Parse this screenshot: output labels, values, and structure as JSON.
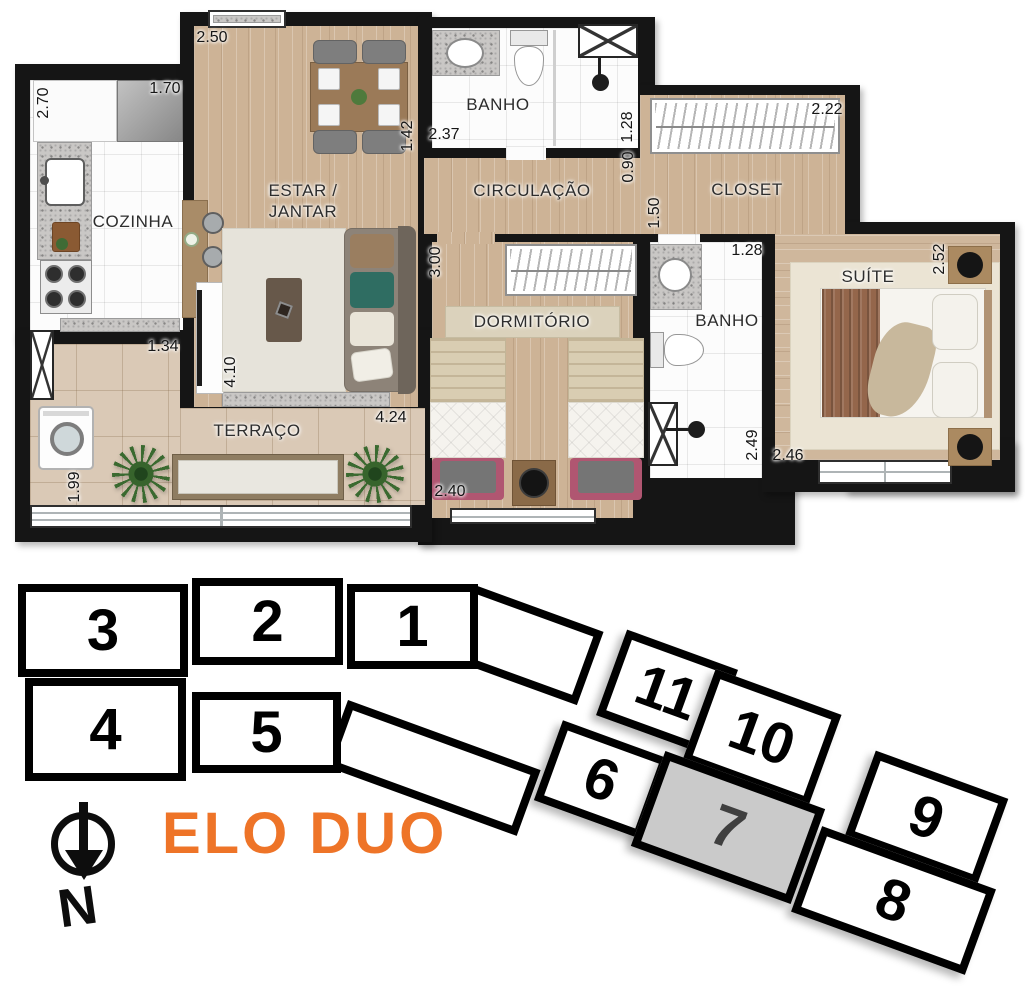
{
  "floor_plan": {
    "rooms": {
      "cozinha": "COZINHA",
      "estar_jantar_line1": "ESTAR /",
      "estar_jantar_line2": "JANTAR",
      "banho_superior": "BANHO",
      "circulacao": "CIRCULAÇÃO",
      "closet": "CLOSET",
      "dormitorio": "DORMITÓRIO",
      "banho_suite": "BANHO",
      "suite": "SUÍTE",
      "terraco": "TERRAÇO"
    },
    "dimensions": {
      "cozinha_profundidade": "2.70",
      "cozinha_largura": "1.70",
      "estar_largura_topo": "2.50",
      "estar_lateral": "1.42",
      "banho_sup_largura": "2.37",
      "banho_sup_profundidade": "1.28",
      "circulacao_largura": "0.90",
      "closet_largura": "2.22",
      "closet_passagem": "1.50",
      "banho_suite_largura": "1.28",
      "suite_profundidade": "2.52",
      "dormitorio_profundidade": "3.00",
      "dormitorio_largura": "2.40",
      "banho_suite_profundidade": "2.49",
      "suite_largura": "2.46",
      "terraco_recuo": "1.34",
      "estar_profundidade": "4.10",
      "terraco_largura": "4.24",
      "terraco_profundidade": "1.99"
    }
  },
  "key_plan": {
    "project_name": "ELO DUO",
    "compass_label": "N",
    "highlighted_unit": "7",
    "units": {
      "u1": "1",
      "u2": "2",
      "u3": "3",
      "u4": "4",
      "u5": "5",
      "u6": "6",
      "u7": "7",
      "u8": "8",
      "u9": "9",
      "u10": "10",
      "u11": "11"
    }
  },
  "colors": {
    "accent_orange": "#EE7428",
    "highlighted_unit_fill": "#CACACA",
    "highlighted_unit_text": "#3F3F3F",
    "wall_black": "#151515",
    "wood_floor": "#CDB396",
    "terrace_floor": "#DAC9B6"
  }
}
